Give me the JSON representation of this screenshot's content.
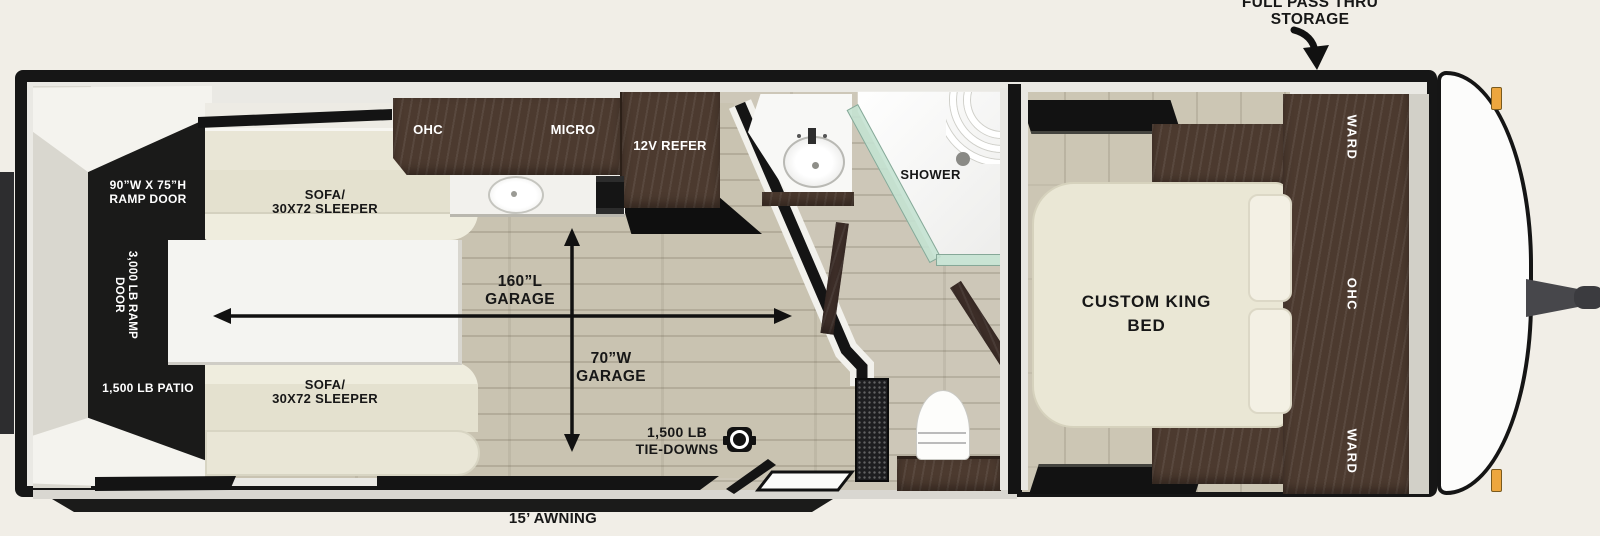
{
  "annotations": {
    "pass_thru_line1": "FULL PASS THRU",
    "pass_thru_line2": "STORAGE",
    "awning": "15’ AWNING"
  },
  "rear": {
    "ramp_size_line1": "90”W X 75”H",
    "ramp_size_line2": "RAMP DOOR",
    "ramp_rating_line1": "3,000 LB RAMP",
    "ramp_rating_line2": "DOOR",
    "patio": "1,500 LB PATIO"
  },
  "garage": {
    "sofa_top_line1": "SOFA/",
    "sofa_top_line2": "30X72 SLEEPER",
    "sofa_bottom_line1": "SOFA/",
    "sofa_bottom_line2": "30X72 SLEEPER",
    "length_line1": "160”L",
    "length_line2": "GARAGE",
    "width_line1": "70”W",
    "width_line2": "GARAGE",
    "tiedowns_line1": "1,500 LB",
    "tiedowns_line2": "TIE-DOWNS",
    "ohc": "OHC",
    "micro": "MICRO",
    "refer": "12V REFER"
  },
  "bathroom": {
    "shower": "SHOWER"
  },
  "bedroom": {
    "bed_line1": "CUSTOM KING",
    "bed_line2": "BED",
    "ward_front": "WARD",
    "ohc": "OHC",
    "ward_rear": "WARD"
  },
  "colors": {
    "wall_black": "#161616",
    "cabinet_wood": "#4c3a2f",
    "garage_floor": "#c9c3b1",
    "sofa_cream": "#e4e1cf",
    "shower_glass": "#c4e2d2",
    "marker_light": "#eda63e",
    "background": "#f1eee7"
  }
}
